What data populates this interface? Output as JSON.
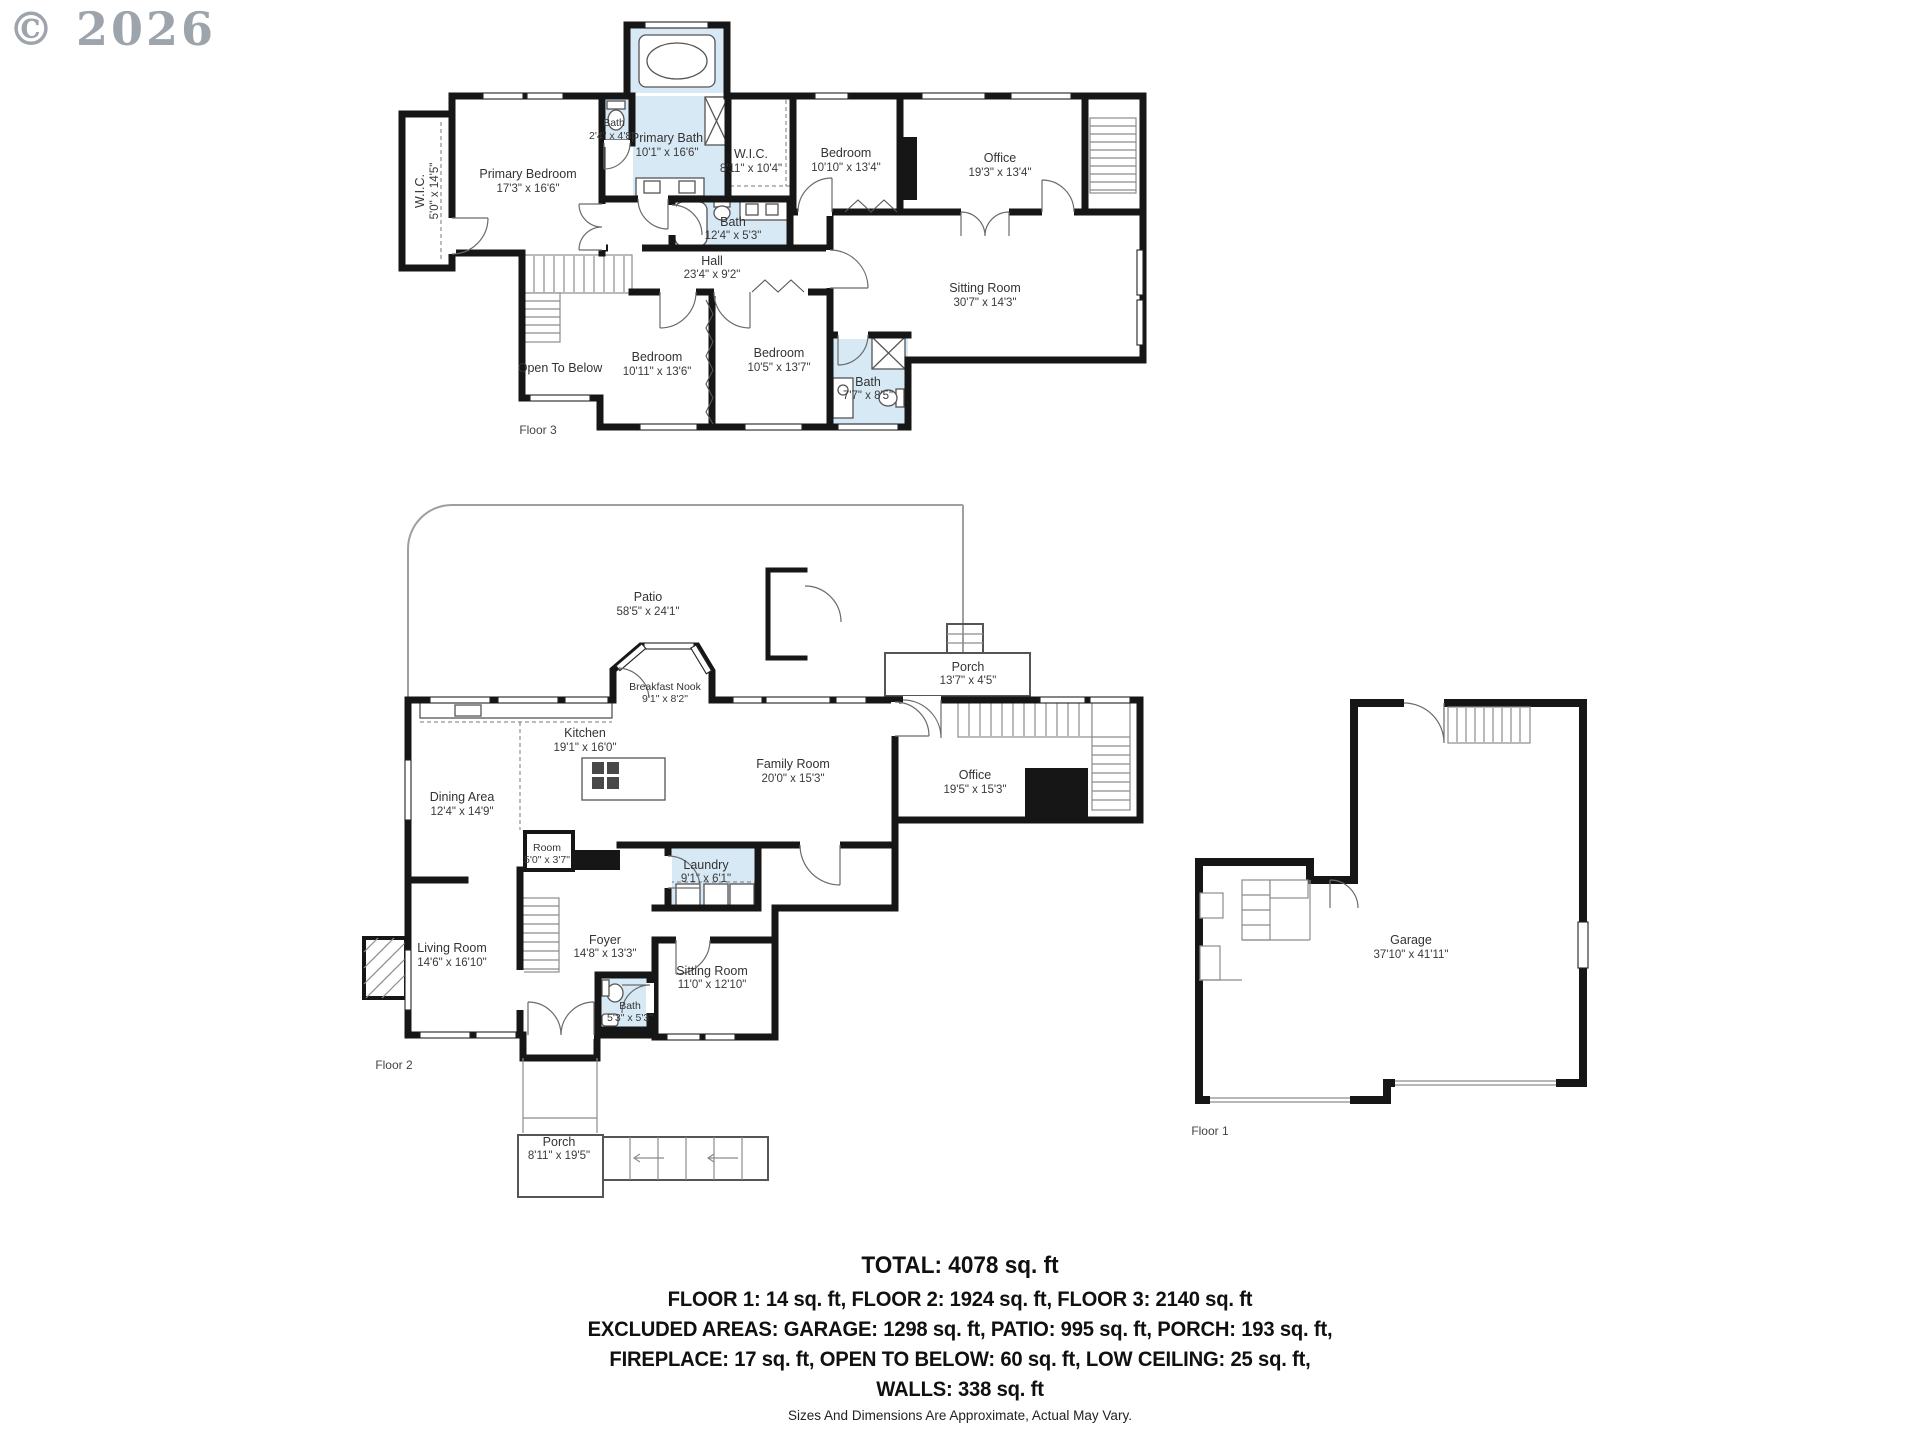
{
  "watermark": "© 2026",
  "colors": {
    "wall": "#161616",
    "wet_room": "#d8e9f6",
    "label": "#333333",
    "watermark": "#969da6"
  },
  "floors": [
    {
      "label": "Floor 3",
      "rooms": [
        {
          "name": "W.I.C.",
          "dims": "5'0\" x 14'5\""
        },
        {
          "name": "Primary Bedroom",
          "dims": "17'3\" x 16'6\""
        },
        {
          "name": "Bath",
          "dims": "2'4\" x 4'8\""
        },
        {
          "name": "Primary Bath",
          "dims": "10'1\" x 16'6\""
        },
        {
          "name": "W.I.C.",
          "dims": "8'11\" x 10'4\""
        },
        {
          "name": "Bedroom",
          "dims": "10'10\" x 13'4\""
        },
        {
          "name": "Office",
          "dims": "19'3\" x 13'4\""
        },
        {
          "name": "Bath",
          "dims": "12'4\" x 5'3\""
        },
        {
          "name": "Hall",
          "dims": "23'4\" x 9'2\""
        },
        {
          "name": "Sitting Room",
          "dims": "30'7\" x 14'3\""
        },
        {
          "name": "Open To Below",
          "dims": ""
        },
        {
          "name": "Bedroom",
          "dims": "10'11\" x 13'6\""
        },
        {
          "name": "Bedroom",
          "dims": "10'5\" x 13'7\""
        },
        {
          "name": "Bath",
          "dims": "7'7\" x 8'5\""
        }
      ]
    },
    {
      "label": "Floor 2",
      "rooms": [
        {
          "name": "Patio",
          "dims": "58'5\" x 24'1\""
        },
        {
          "name": "Porch",
          "dims": "13'7\" x 4'5\""
        },
        {
          "name": "Breakfast Nook",
          "dims": "9'1\" x 8'2\""
        },
        {
          "name": "Kitchen",
          "dims": "19'1\" x 16'0\""
        },
        {
          "name": "Family Room",
          "dims": "20'0\" x 15'3\""
        },
        {
          "name": "Office",
          "dims": "19'5\" x 15'3\""
        },
        {
          "name": "Dining Area",
          "dims": "12'4\" x 14'9\""
        },
        {
          "name": "Room",
          "dims": "5'0\" x 3'7\""
        },
        {
          "name": "Laundry",
          "dims": "9'1\" x 6'1\""
        },
        {
          "name": "Living Room",
          "dims": "14'6\" x 16'10\""
        },
        {
          "name": "Foyer",
          "dims": "14'8\" x 13'3\""
        },
        {
          "name": "Sitting Room",
          "dims": "11'0\" x 12'10\""
        },
        {
          "name": "Bath",
          "dims": "5'3\" x 5'3\""
        },
        {
          "name": "Porch",
          "dims": "8'11\" x 19'5\""
        }
      ]
    },
    {
      "label": "Floor 1",
      "rooms": [
        {
          "name": "Garage",
          "dims": "37'10\" x 41'11\""
        }
      ]
    }
  ],
  "summary": {
    "total": "TOTAL: 4078 sq. ft",
    "lines": [
      "FLOOR 1: 14 sq. ft, FLOOR 2: 1924 sq. ft, FLOOR 3: 2140 sq. ft",
      "EXCLUDED AREAS: GARAGE: 1298 sq. ft, PATIO: 995 sq. ft, PORCH: 193 sq. ft,",
      "FIREPLACE: 17 sq. ft, OPEN TO BELOW: 60 sq. ft, LOW CEILING: 25 sq. ft,",
      "WALLS: 338 sq. ft"
    ]
  },
  "disclaimer": "Sizes And Dimensions Are Approximate, Actual May Vary."
}
